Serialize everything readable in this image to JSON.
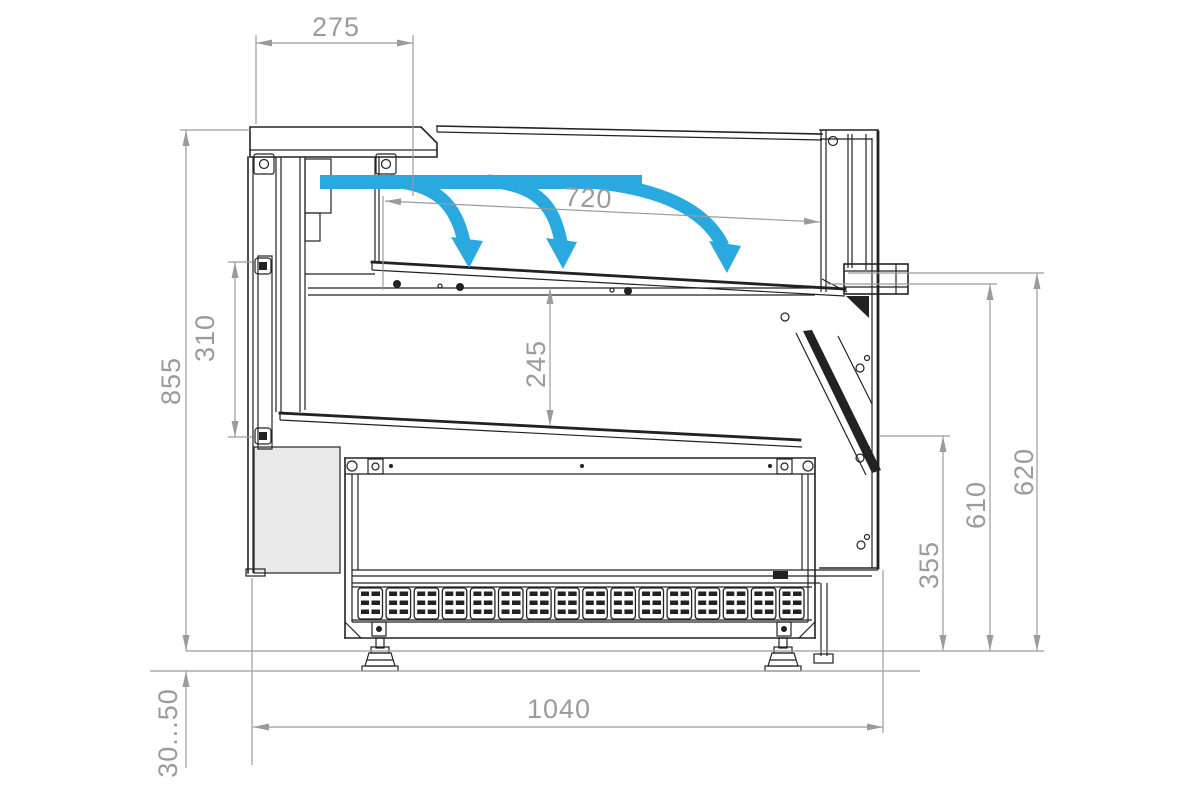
{
  "drawing": {
    "type": "technical-cross-section",
    "subject": "refrigerated serve-over display counter, side section with dimensions and air-curtain flow"
  },
  "colors": {
    "linework": "#222222",
    "dimension_gray": "#9b9b9b",
    "airflow_blue": "#29a9e0",
    "panel_shade": "#e9e9e9",
    "background": "#ffffff"
  },
  "dimensions": {
    "top_width": {
      "label": "275",
      "value_mm": 275
    },
    "inner_width": {
      "label": "720",
      "value_mm": 720
    },
    "left_inner_height": {
      "label": "310",
      "value_mm": 310
    },
    "left_overall_height": {
      "label": "855",
      "value_mm": 855
    },
    "center_depth": {
      "label": "245",
      "value_mm": 245
    },
    "right_lower_height": {
      "label": "355",
      "value_mm": 355
    },
    "right_middle_height": {
      "label": "610",
      "value_mm": 610
    },
    "right_outer_height": {
      "label": "620",
      "value_mm": 620
    },
    "bottom_width": {
      "label": "1040",
      "value_mm": 1040
    },
    "leg_height_range": {
      "label": "30...50",
      "range_mm": [
        30,
        50
      ]
    }
  },
  "airflow": {
    "type": "air-curtain",
    "arrow_count": 3,
    "direction": "from rear duct across display area, curving down to deck"
  },
  "base": {
    "louver_grille": {
      "cell_count": 16,
      "slots_per_cell": 6
    }
  }
}
